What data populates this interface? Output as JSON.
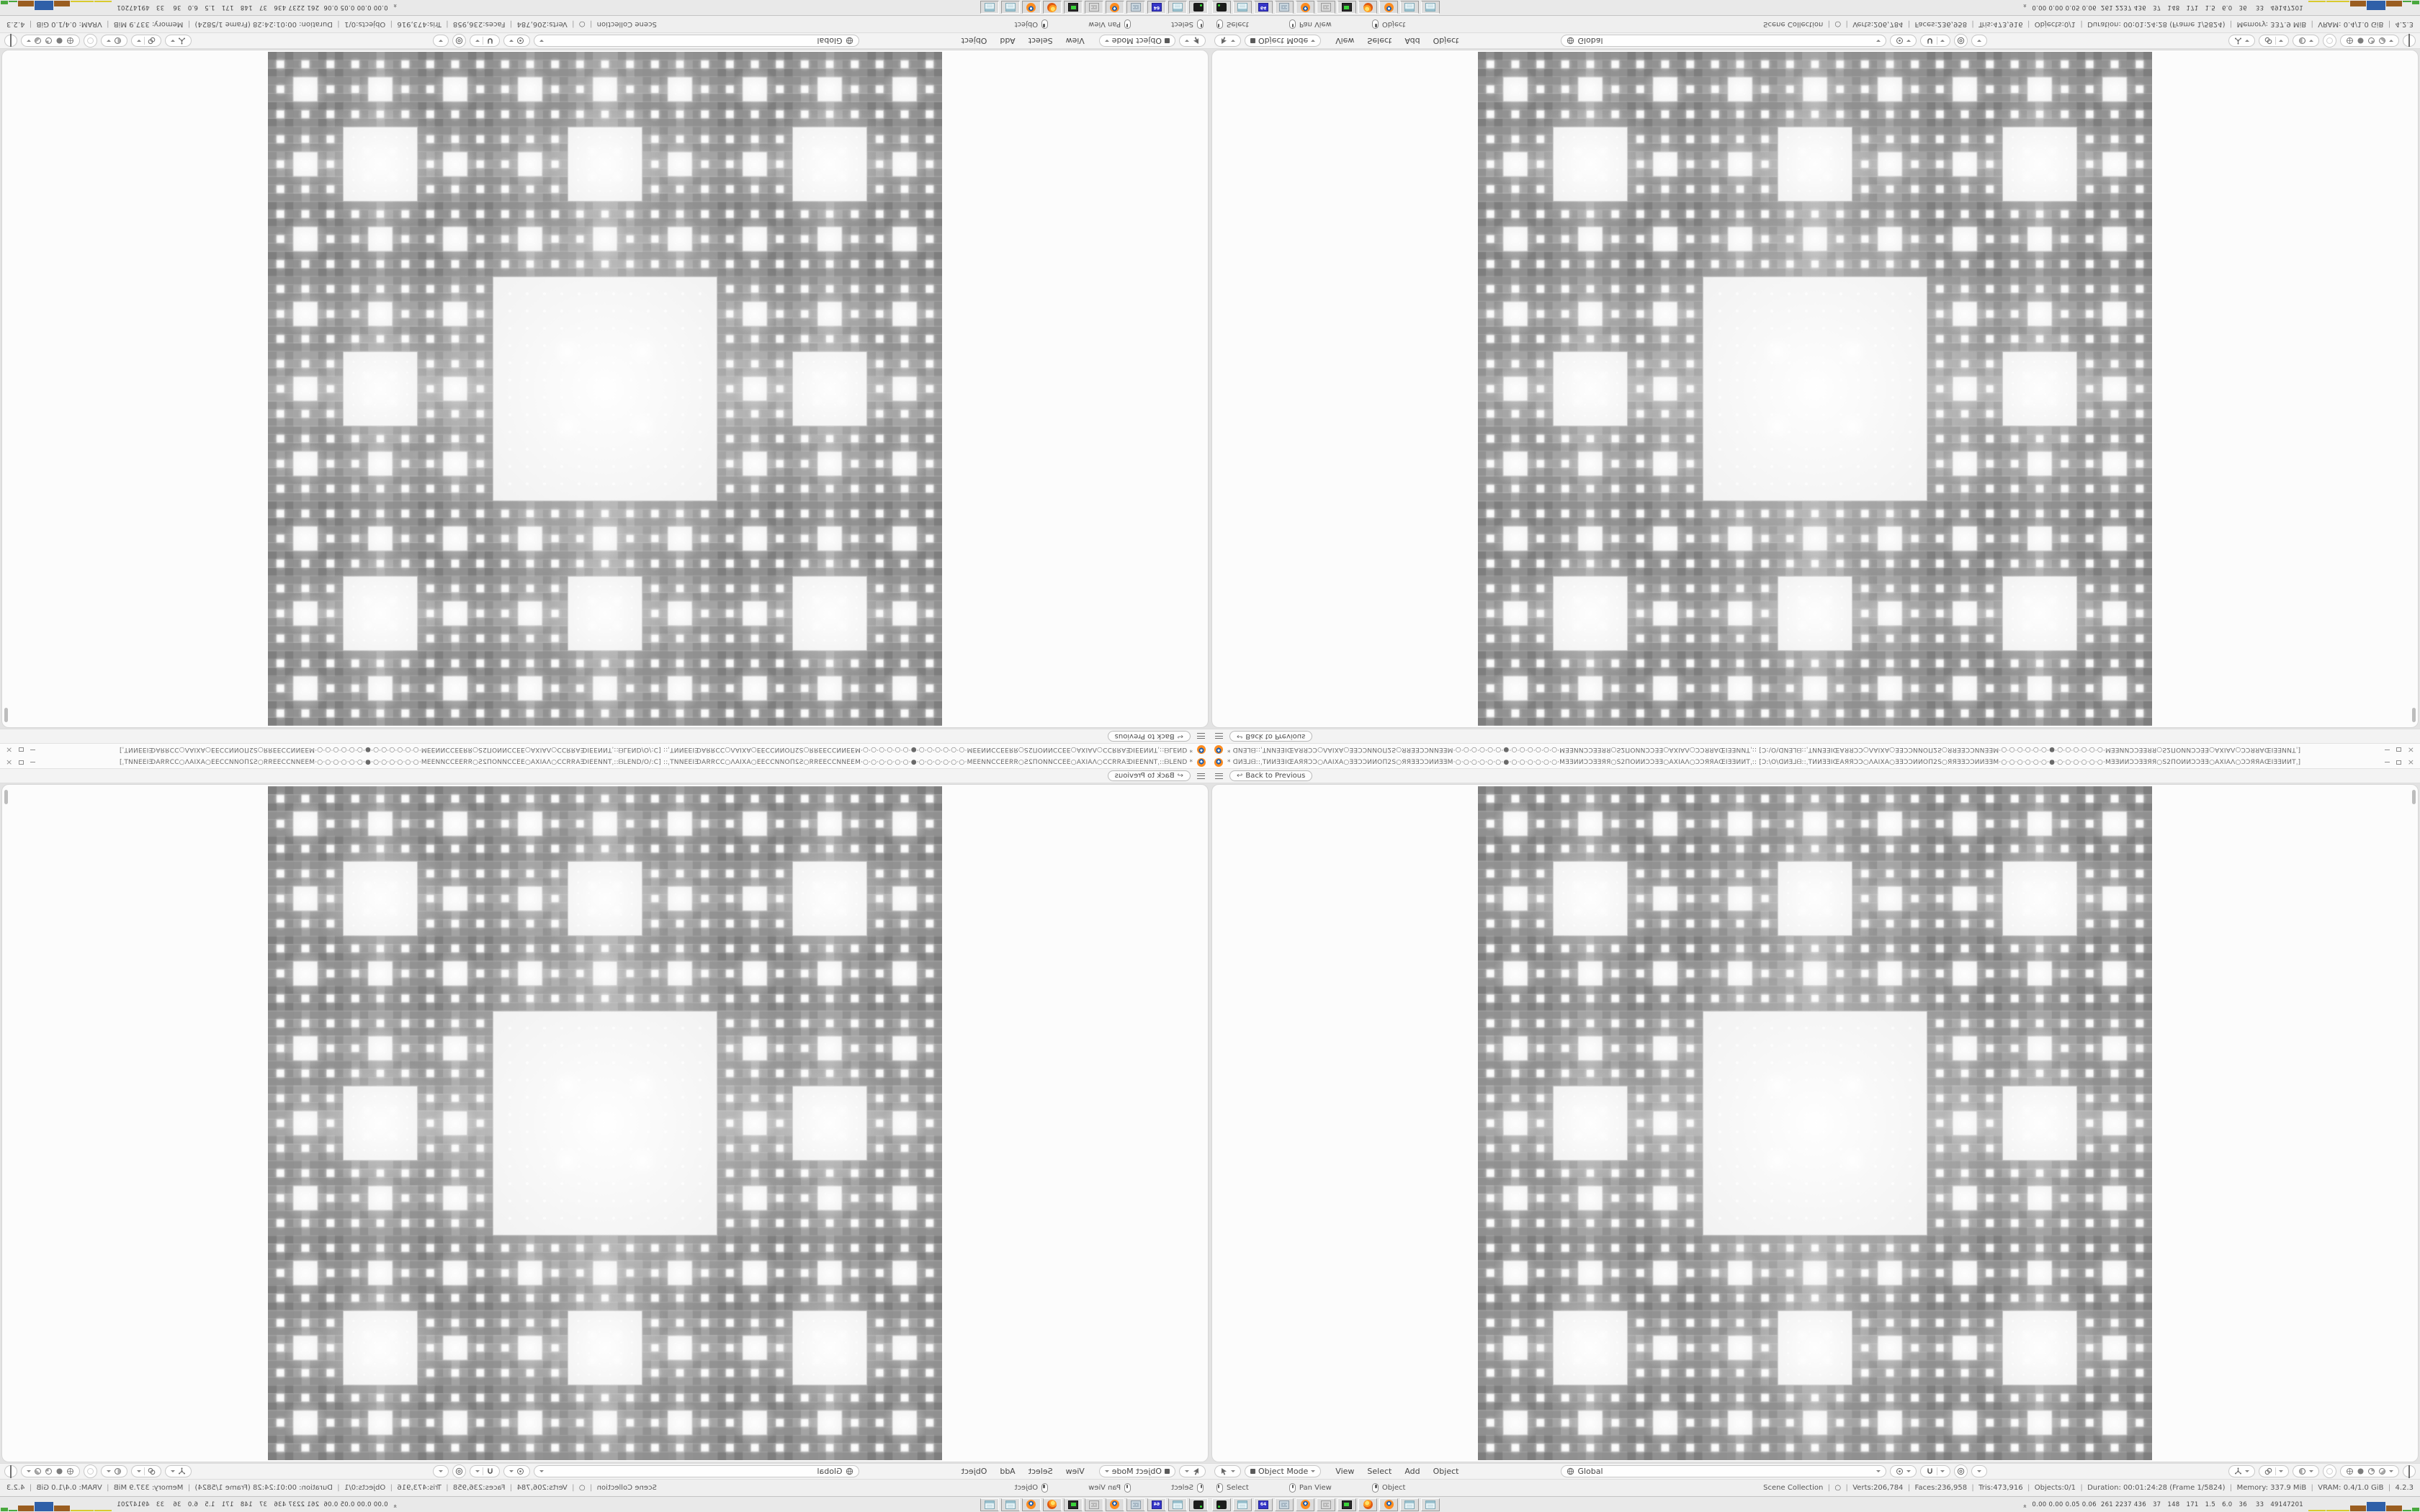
{
  "app": "Blender",
  "window": {
    "title": "* ᗡИƎ⅃ᗺ::ˌTИИƎƎIŒAЯЯƆƆ○ΛAIXA○ƎƎƆƆИИOΠ2S○ЯЯƎƎƆƆИИƎƎM·○·○·○·○·○·○·●·○·○·○·○·○·○·MƎƎИИƆƆƎƎЯЯ○S2ΠOИИƆƆƎƎ○AXIAΛ○ƆƆЯЯAŒIƎƎИИTˌ:: [Ɔ:\\O\\ᗡИƎ⅃ᗺ::ˌTИИƎƎIŒAЯЯƆƆ○ΛAIXA○ƎƎƆƆИИOΠ2S○ЯЯƎƎƆƆИИƎƎM·○·○·○·○·○·○·●·○·○·○·○·○·○·MƎƎИИƆƆƎƎЯЯ○S2ΠOИИƆƆƎƎ○AXIAΛ○ƆƆЯЯAŒIƎƎИИTˌ]",
    "controls": [
      "minimize",
      "maximize",
      "close"
    ]
  },
  "topbar": {
    "back_label": "Back to Previous"
  },
  "viewport_header": {
    "mode_label": "Object Mode",
    "menus": [
      "View",
      "Select",
      "Add",
      "Object"
    ],
    "orientation_label": "Global"
  },
  "status_bar": {
    "hints": [
      {
        "mouse": "left",
        "label": "Select"
      },
      {
        "mouse": "middle",
        "label": "Pan View"
      },
      {
        "mouse": "right",
        "label": "Object"
      }
    ],
    "stats": [
      "Scene Collection",
      "○",
      "Verts:206,784",
      "Faces:236,958",
      "Tris:473,916",
      "Objects:0/1",
      "Duration: 00:01:24:28 (Frame 1/5824)",
      "Memory: 337.9 MiB",
      "VRAM: 0.4/1.0 GiB",
      "4.2.3"
    ]
  },
  "taskbar": {
    "apps": [
      "recorder-dark",
      "notepad",
      "floppy-64",
      "calculator-blue",
      "blender",
      "calculator-grey",
      "system-monitor",
      "firefox",
      "blender",
      "notepad",
      "notepad"
    ],
    "floppy_label": "64",
    "profiler": {
      "values_text": "0.00 0.00 0.05 0.06  261 2237 436   37   148   171   1.5   6.0   36    33   49147201",
      "bars": [
        {
          "color": "#d9ca2e",
          "w": 24,
          "h": 2
        },
        {
          "color": "#d9ca2e",
          "w": 32,
          "h": 2
        },
        {
          "color": "#9a5d20",
          "w": 22,
          "h": 8
        },
        {
          "color": "#2f5fa8",
          "w": 26,
          "h": 13
        },
        {
          "color": "#9a5d20",
          "w": 22,
          "h": 8
        },
        {
          "color": "#49a83e",
          "w": 12,
          "h": 2
        },
        {
          "color": "#49a83e",
          "w": 10,
          "h": 5
        },
        {
          "color": "#49a83e",
          "w": 12,
          "h": 2
        }
      ]
    }
  },
  "viewport": {
    "fractal": {
      "type": "menger-carpet-front",
      "grid": 81,
      "depth": 4,
      "base_gray_min": 126,
      "base_gray_max": 214,
      "hole_color": "#f2f2f2"
    }
  },
  "layout": {
    "quadrant_transforms": [
      "rotate-180",
      "flip-vertical",
      "flip-horizontal",
      "normal"
    ]
  }
}
